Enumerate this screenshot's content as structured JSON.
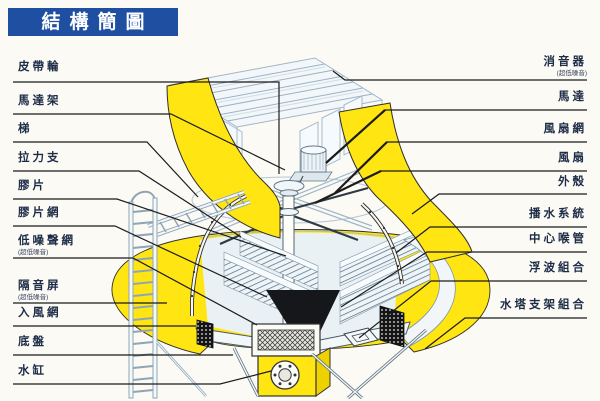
{
  "title": "結構簡圖",
  "labels": {
    "left": [
      {
        "text": "皮帶輪"
      },
      {
        "text": "馬達架"
      },
      {
        "text": "梯"
      },
      {
        "text": "拉力支"
      },
      {
        "text": "膠片"
      },
      {
        "text": "膠片網"
      },
      {
        "text": "低噪聲網",
        "note": "(超低噪音)"
      },
      {
        "text": "隔音屏",
        "note": "(超低噪音)"
      },
      {
        "text": "入風網"
      },
      {
        "text": "底盤"
      },
      {
        "text": "水缸"
      }
    ],
    "right": [
      {
        "text": "消音器",
        "note": "(超低噪音)"
      },
      {
        "text": "馬達"
      },
      {
        "text": "風扇網"
      },
      {
        "text": "風扇"
      },
      {
        "text": "外殼"
      },
      {
        "text": "播水系統"
      },
      {
        "text": "中心喉管"
      },
      {
        "text": "浮波組合"
      },
      {
        "text": "水塔支架組合"
      }
    ]
  },
  "colors": {
    "title_blue": "#1e4fa1",
    "shell_yellow": "#ffe512",
    "structure_blue": "#9ab3c6",
    "leader_line": "#1b1b1b"
  }
}
